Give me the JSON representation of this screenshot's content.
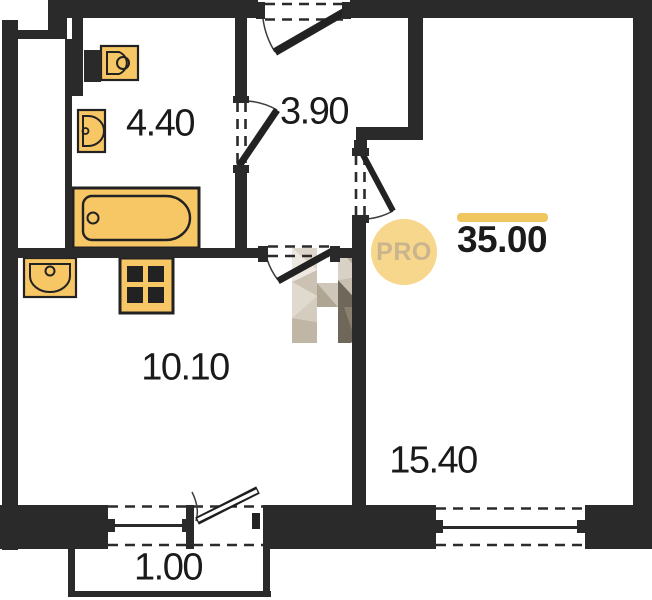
{
  "floor_plan": {
    "total_area": "35.00",
    "badge_label": "PRO",
    "rooms": [
      {
        "name": "bathroom",
        "area": "4.40"
      },
      {
        "name": "hallway",
        "area": "3.90"
      },
      {
        "name": "kitchen-living-room",
        "area": "10.10"
      },
      {
        "name": "room",
        "area": "15.40"
      },
      {
        "name": "balcony",
        "area": "1.00"
      }
    ],
    "fixtures": [
      "toilet",
      "sink",
      "bathtub",
      "kitchen-sink",
      "stove"
    ],
    "colors": {
      "wall": "#2a2a2a",
      "fixture_fill": "#F7C766",
      "accent_bar": "#F0C75F",
      "badge_fill": "#F6D78C",
      "badge_text": "#C9B48E",
      "watermark_light": "#EDE8E0",
      "watermark_dark": "#6F6759"
    }
  }
}
